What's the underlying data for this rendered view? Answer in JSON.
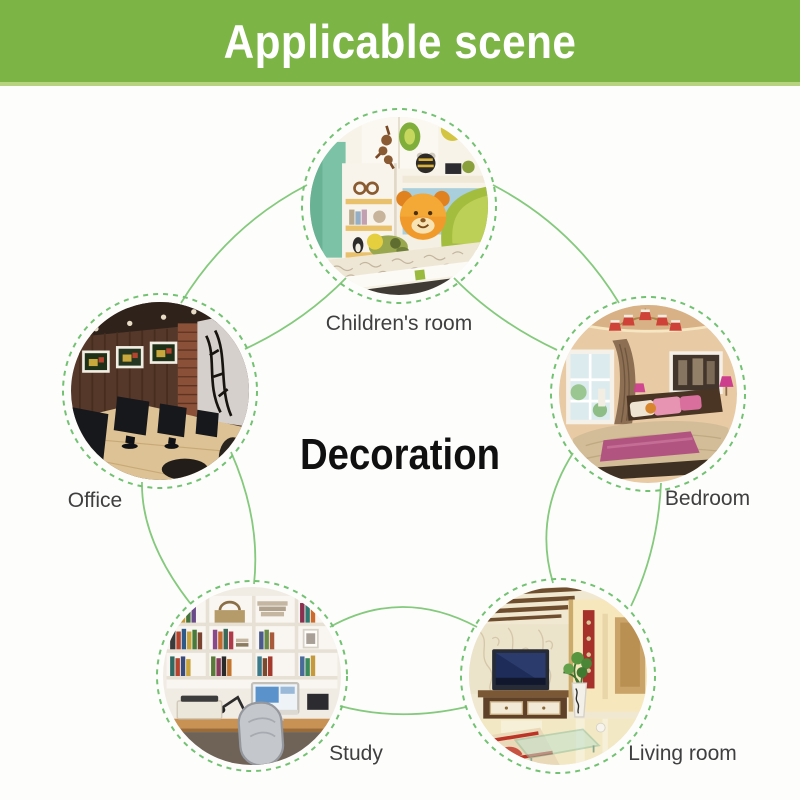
{
  "header": {
    "title": "Applicable scene",
    "background": "#7cb446",
    "underline": "#b7d37f",
    "text_color": "#ffffff"
  },
  "center": {
    "label": "Decoration",
    "text_color": "#101010"
  },
  "scenes": [
    {
      "id": "children-room",
      "label": "Children's room",
      "position": "top"
    },
    {
      "id": "office",
      "label": "Office",
      "position": "left"
    },
    {
      "id": "bedroom",
      "label": "Bedroom",
      "position": "right"
    },
    {
      "id": "study",
      "label": "Study",
      "position": "bottom-left"
    },
    {
      "id": "living-room",
      "label": "Living room",
      "position": "bottom-right"
    }
  ],
  "colors": {
    "connector_line": "#84c97c",
    "circle_dash": "#72c272",
    "label_text": "#3f3f3f",
    "page_background": "#fdfdfc"
  }
}
